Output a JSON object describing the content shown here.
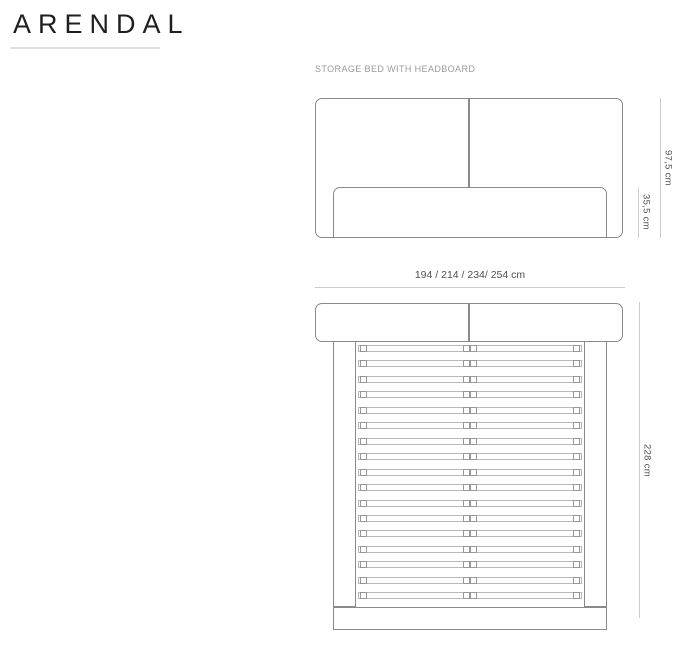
{
  "page": {
    "title": "ARENDAL",
    "subtitle": "STORAGE BED WITH HEADBOARD"
  },
  "front_view": {
    "total_height_label": "97,5 cm",
    "base_height_label": "35,5 cm"
  },
  "top_view": {
    "width_options_label": "194 / 214 / 234/ 254 cm",
    "length_label": "228 cm",
    "slat_count": 17,
    "slat_spacing_px": 15.45
  },
  "colors": {
    "title_text": "#1f1f1f",
    "subtitle_text": "#9b9b9b",
    "furniture_outline": "#8a8a8a",
    "slat_outline": "#b9b9b9",
    "bracket_outline": "#989898",
    "dimension_line": "#cbcbcb",
    "dimension_text": "#4f4f4f",
    "title_underline": "#dedede"
  }
}
